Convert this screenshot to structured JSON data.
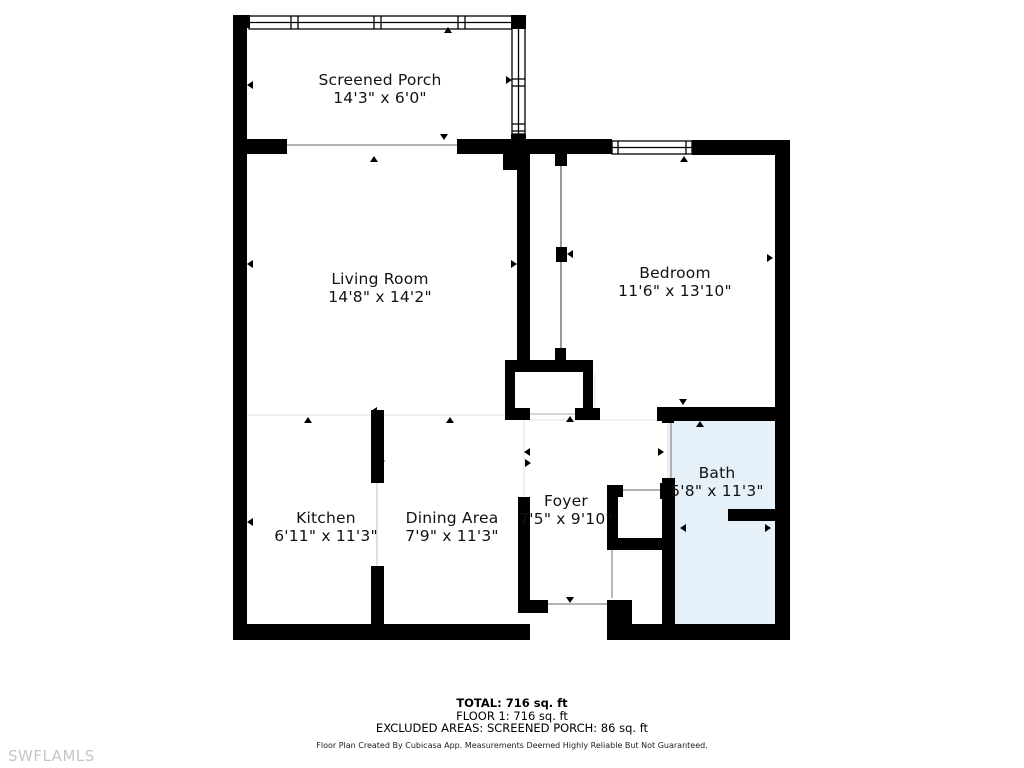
{
  "rooms": [
    {
      "name": "Screened Porch",
      "dims": "14'3\" x 6'0\""
    },
    {
      "name": "Living Room",
      "dims": "14'8\" x 14'2\""
    },
    {
      "name": "Bedroom",
      "dims": "11'6\" x 13'10\""
    },
    {
      "name": "Kitchen",
      "dims": "6'11\" x 11'3\""
    },
    {
      "name": "Dining Area",
      "dims": "7'9\" x 11'3\""
    },
    {
      "name": "Foyer",
      "dims": "7'5\" x 9'10\""
    },
    {
      "name": "Bath",
      "dims": "5'8\" x 11'3\""
    }
  ],
  "summary": {
    "total": "TOTAL: 716 sq. ft",
    "floor1": "FLOOR 1: 716 sq. ft",
    "excluded": "EXCLUDED AREAS: SCREENED PORCH: 86 sq. ft"
  },
  "footer": {
    "credit": "Floor Plan Created By Cubicasa App. Measurements Deemed Highly Reliable But Not Guaranteed."
  },
  "watermark": "SWFLAMLS",
  "colors": {
    "wall": "#000000",
    "bath_fill": "#e6f0f9",
    "boundary_line": "#e0e0e0",
    "opening_line": "#888888",
    "watermark_gray": "#c6c6c6"
  }
}
